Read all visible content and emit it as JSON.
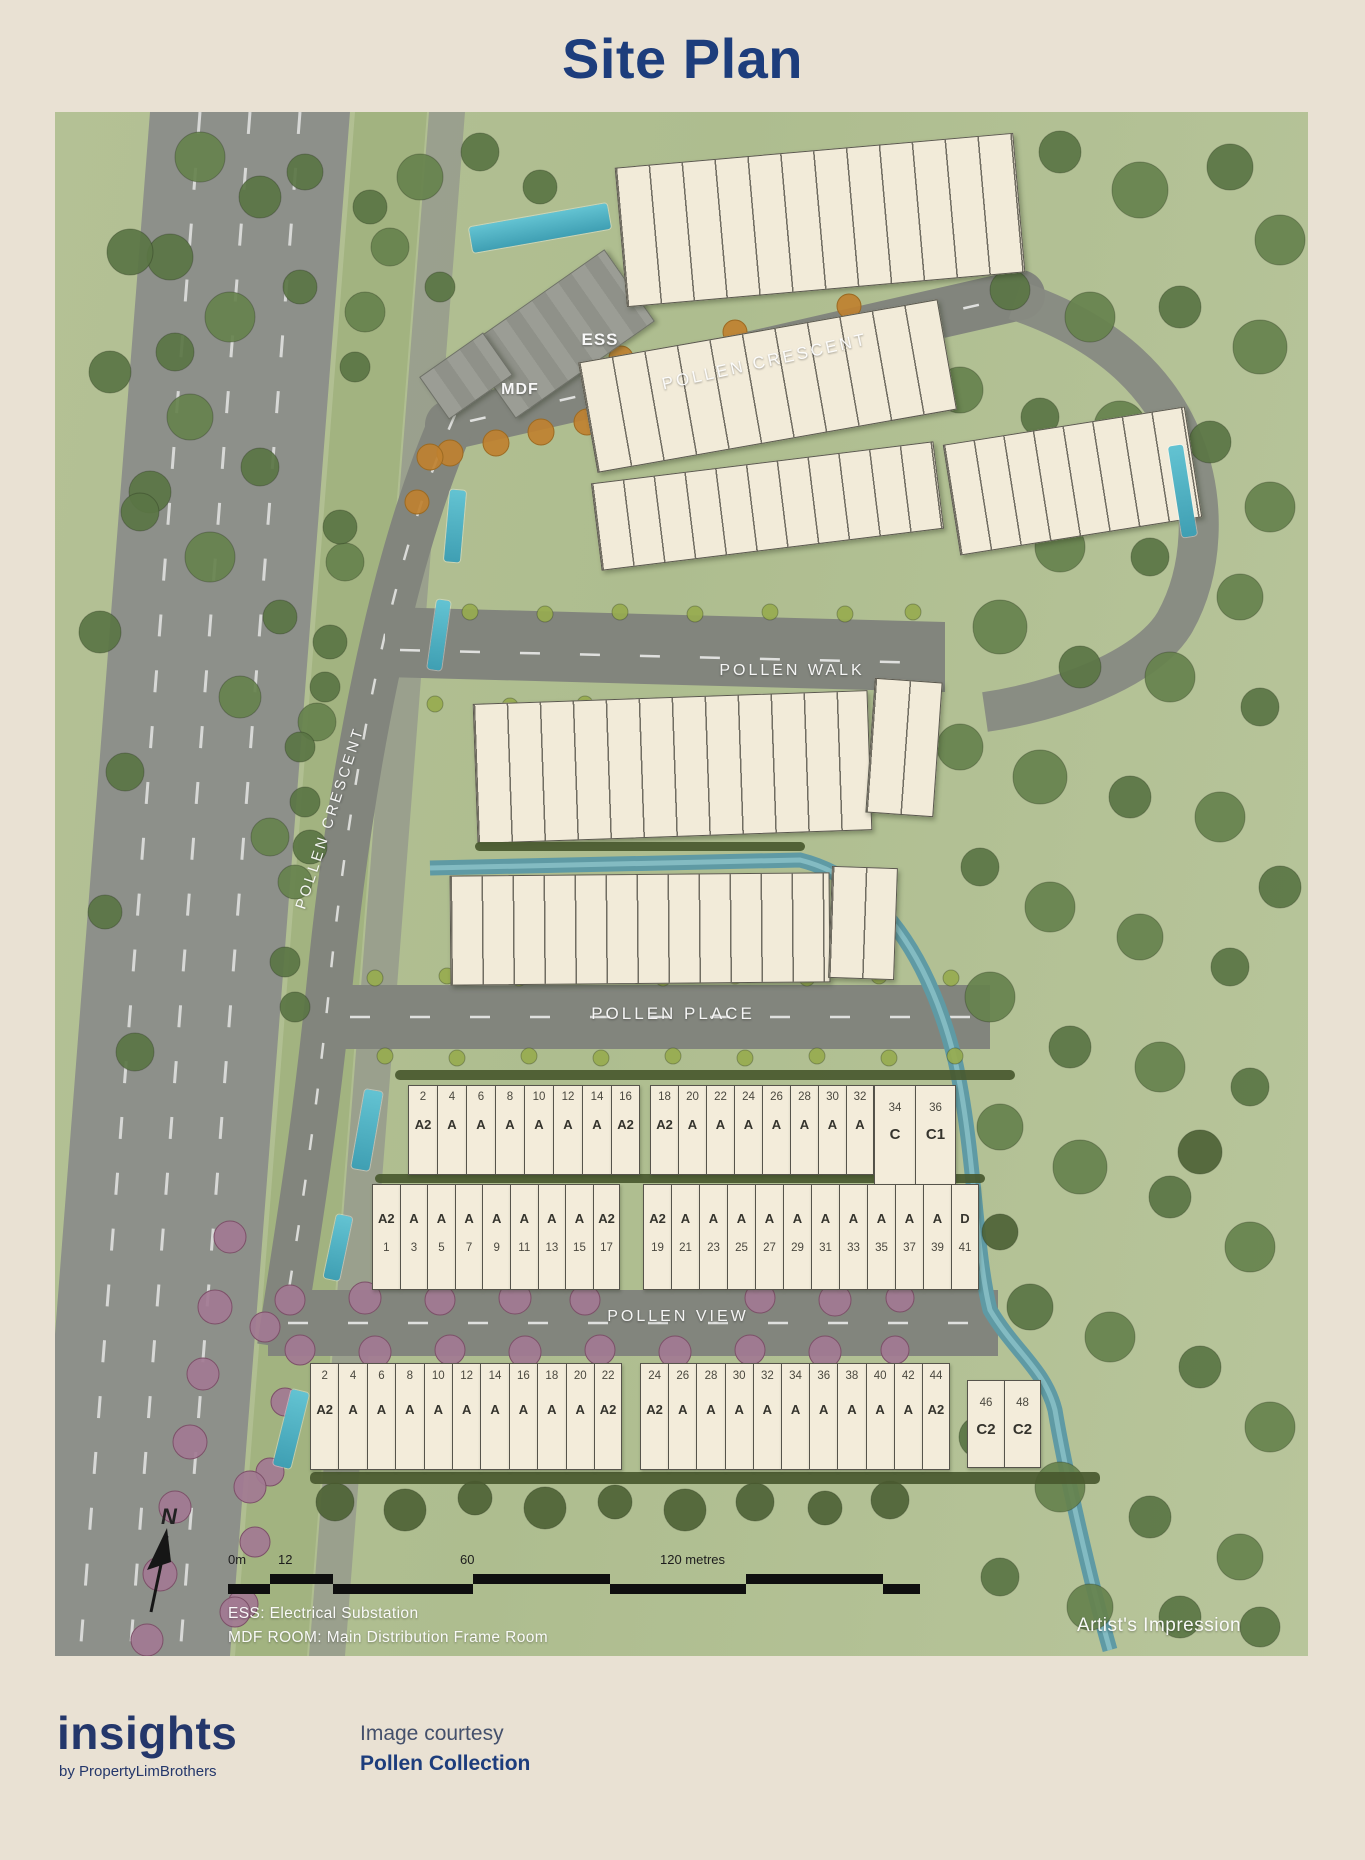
{
  "page": {
    "title": "Site Plan",
    "navy": "#1d3d7c",
    "cream": "#e9e1d3"
  },
  "plan": {
    "streets": {
      "crescent_top": "POLLEN CRESCENT",
      "crescent_left": "POLLEN CRESCENT",
      "walk": "POLLEN WALK",
      "place": "POLLEN PLACE",
      "view": "POLLEN VIEW"
    },
    "facilities": {
      "ess": "ESS",
      "mdf": "MDF"
    },
    "north": "N",
    "scale_labels": {
      "zero": "0m",
      "twelve": "12",
      "sixty": "60",
      "end": "120 metres"
    },
    "legend_line1": "ESS:  Electrical Substation",
    "legend_line2": "MDF ROOM: Main Distribution Frame Room",
    "artists_impression": "Artist's Impression",
    "blocks": {
      "place_row_a": [
        {
          "no": "2",
          "ty": "A2"
        },
        {
          "no": "4",
          "ty": "A"
        },
        {
          "no": "6",
          "ty": "A"
        },
        {
          "no": "8",
          "ty": "A"
        },
        {
          "no": "10",
          "ty": "A"
        },
        {
          "no": "12",
          "ty": "A"
        },
        {
          "no": "14",
          "ty": "A"
        },
        {
          "no": "16",
          "ty": "A2"
        }
      ],
      "place_row_b": [
        {
          "no": "18",
          "ty": "A2"
        },
        {
          "no": "20",
          "ty": "A"
        },
        {
          "no": "22",
          "ty": "A"
        },
        {
          "no": "24",
          "ty": "A"
        },
        {
          "no": "26",
          "ty": "A"
        },
        {
          "no": "28",
          "ty": "A"
        },
        {
          "no": "30",
          "ty": "A"
        },
        {
          "no": "32",
          "ty": "A"
        }
      ],
      "place_row_c": [
        {
          "no": "34",
          "ty": "C"
        },
        {
          "no": "36",
          "ty": "C1"
        }
      ],
      "mid_row_a": [
        {
          "no": "1",
          "ty": "A2"
        },
        {
          "no": "3",
          "ty": "A"
        },
        {
          "no": "5",
          "ty": "A"
        },
        {
          "no": "7",
          "ty": "A"
        },
        {
          "no": "9",
          "ty": "A"
        },
        {
          "no": "11",
          "ty": "A"
        },
        {
          "no": "13",
          "ty": "A"
        },
        {
          "no": "15",
          "ty": "A"
        },
        {
          "no": "17",
          "ty": "A2"
        }
      ],
      "mid_row_b": [
        {
          "no": "19",
          "ty": "A2"
        },
        {
          "no": "21",
          "ty": "A"
        },
        {
          "no": "23",
          "ty": "A"
        },
        {
          "no": "25",
          "ty": "A"
        },
        {
          "no": "27",
          "ty": "A"
        },
        {
          "no": "29",
          "ty": "A"
        },
        {
          "no": "31",
          "ty": "A"
        },
        {
          "no": "33",
          "ty": "A"
        },
        {
          "no": "35",
          "ty": "A"
        },
        {
          "no": "37",
          "ty": "A"
        },
        {
          "no": "39",
          "ty": "A"
        },
        {
          "no": "41",
          "ty": "D"
        }
      ],
      "view_row_a": [
        {
          "no": "2",
          "ty": "A2"
        },
        {
          "no": "4",
          "ty": "A"
        },
        {
          "no": "6",
          "ty": "A"
        },
        {
          "no": "8",
          "ty": "A"
        },
        {
          "no": "10",
          "ty": "A"
        },
        {
          "no": "12",
          "ty": "A"
        },
        {
          "no": "14",
          "ty": "A"
        },
        {
          "no": "16",
          "ty": "A"
        },
        {
          "no": "18",
          "ty": "A"
        },
        {
          "no": "20",
          "ty": "A"
        },
        {
          "no": "22",
          "ty": "A2"
        }
      ],
      "view_row_b": [
        {
          "no": "24",
          "ty": "A2"
        },
        {
          "no": "26",
          "ty": "A"
        },
        {
          "no": "28",
          "ty": "A"
        },
        {
          "no": "30",
          "ty": "A"
        },
        {
          "no": "32",
          "ty": "A"
        },
        {
          "no": "34",
          "ty": "A"
        },
        {
          "no": "36",
          "ty": "A"
        },
        {
          "no": "38",
          "ty": "A"
        },
        {
          "no": "40",
          "ty": "A"
        },
        {
          "no": "42",
          "ty": "A"
        },
        {
          "no": "44",
          "ty": "A2"
        }
      ],
      "view_row_c": [
        {
          "no": "46",
          "ty": "C2"
        },
        {
          "no": "48",
          "ty": "C2"
        }
      ]
    }
  },
  "footer": {
    "logo": "insights",
    "logo_sub": "by PropertyLimBrothers",
    "courtesy_line1": "Image courtesy",
    "courtesy_line2": "Pollen Collection"
  }
}
